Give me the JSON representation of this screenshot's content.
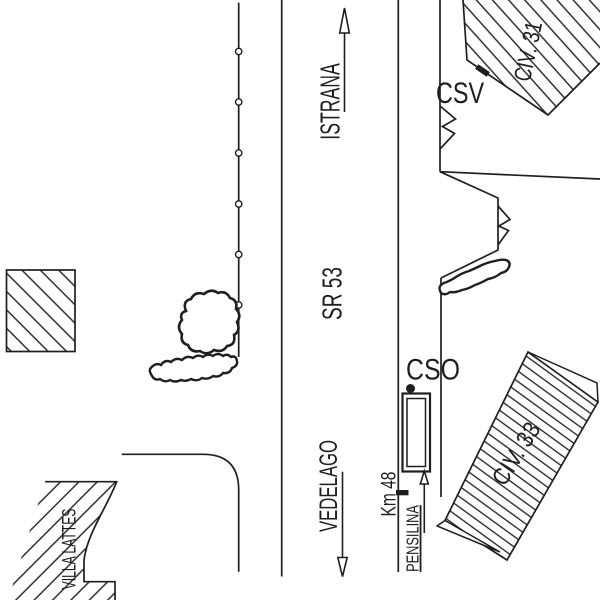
{
  "drawing": {
    "background_color": "#ffffff",
    "ink_color": "#1f1f1f"
  },
  "labels": {
    "istrana": "ISTRANA",
    "sr53": "SR 53",
    "vedelago": "VEDELAGO",
    "km48": "Km 48",
    "pensilina": "PENSILINA",
    "villa_lattes": "VILLA LATTES",
    "csv": "CSV",
    "cso": "CSO",
    "civ31": "CIV. 31",
    "civ33": "CIV. 33"
  }
}
